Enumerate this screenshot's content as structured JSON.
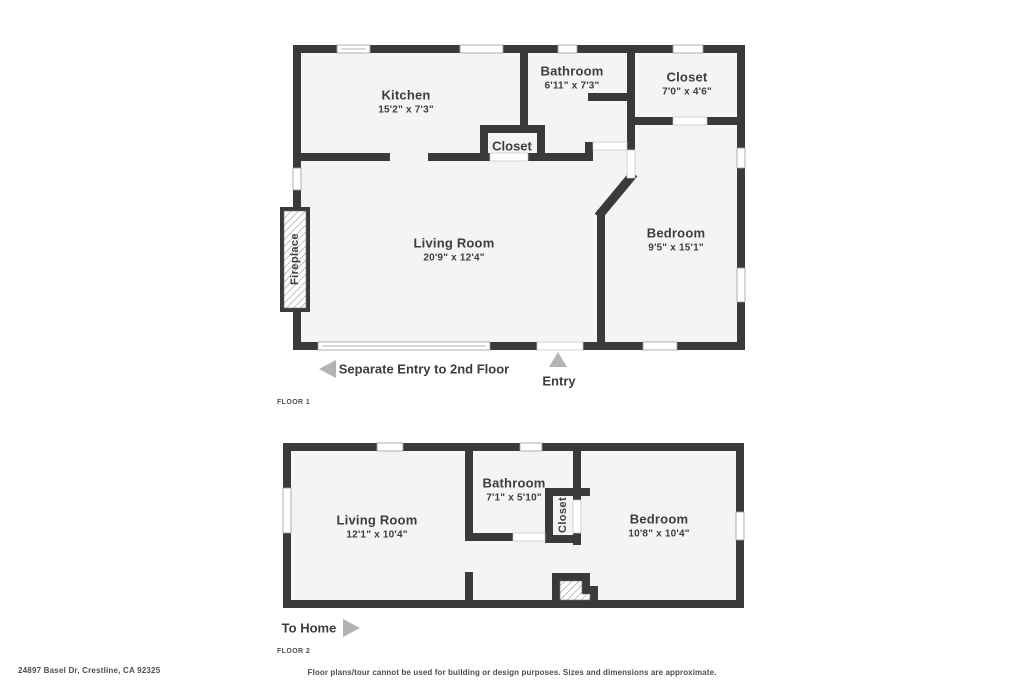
{
  "colors": {
    "wall": "#3a3a3c",
    "room_fill": "#f4f4f5",
    "text": "#3d3d40",
    "muted_text": "#4e4e4e",
    "arrow": "#b3b3b3"
  },
  "floor1": {
    "label": "FLOOR 1",
    "rooms": {
      "kitchen": {
        "name": "Kitchen",
        "dims": "15'2\" x 7'3\""
      },
      "bathroom": {
        "name": "Bathroom",
        "dims": "6'11\" x 7'3\""
      },
      "closet_top": {
        "name": "Closet",
        "dims": "7'0\" x 4'6\""
      },
      "closet_mid": {
        "name": "Closet"
      },
      "living": {
        "name": "Living Room",
        "dims": "20'9\" x 12'4\""
      },
      "bedroom": {
        "name": "Bedroom",
        "dims": "9'5\" x 15'1\""
      },
      "fireplace": {
        "name": "Fireplace"
      }
    },
    "annotations": {
      "separate_entry": "Separate Entry to 2nd Floor",
      "entry": "Entry"
    }
  },
  "floor2": {
    "label": "FLOOR 2",
    "rooms": {
      "living": {
        "name": "Living Room",
        "dims": "12'1\" x 10'4\""
      },
      "bathroom": {
        "name": "Bathroom",
        "dims": "7'1\" x 5'10\""
      },
      "closet": {
        "name": "Closet"
      },
      "bedroom": {
        "name": "Bedroom",
        "dims": "10'8\" x 10'4\""
      }
    },
    "annotations": {
      "to_home": "To Home"
    }
  },
  "footer": {
    "address": "24897 Basel Dr, Crestline, CA 92325",
    "disclaimer": "Floor plans/tour cannot be used for building or design purposes. Sizes and dimensions are approximate."
  }
}
